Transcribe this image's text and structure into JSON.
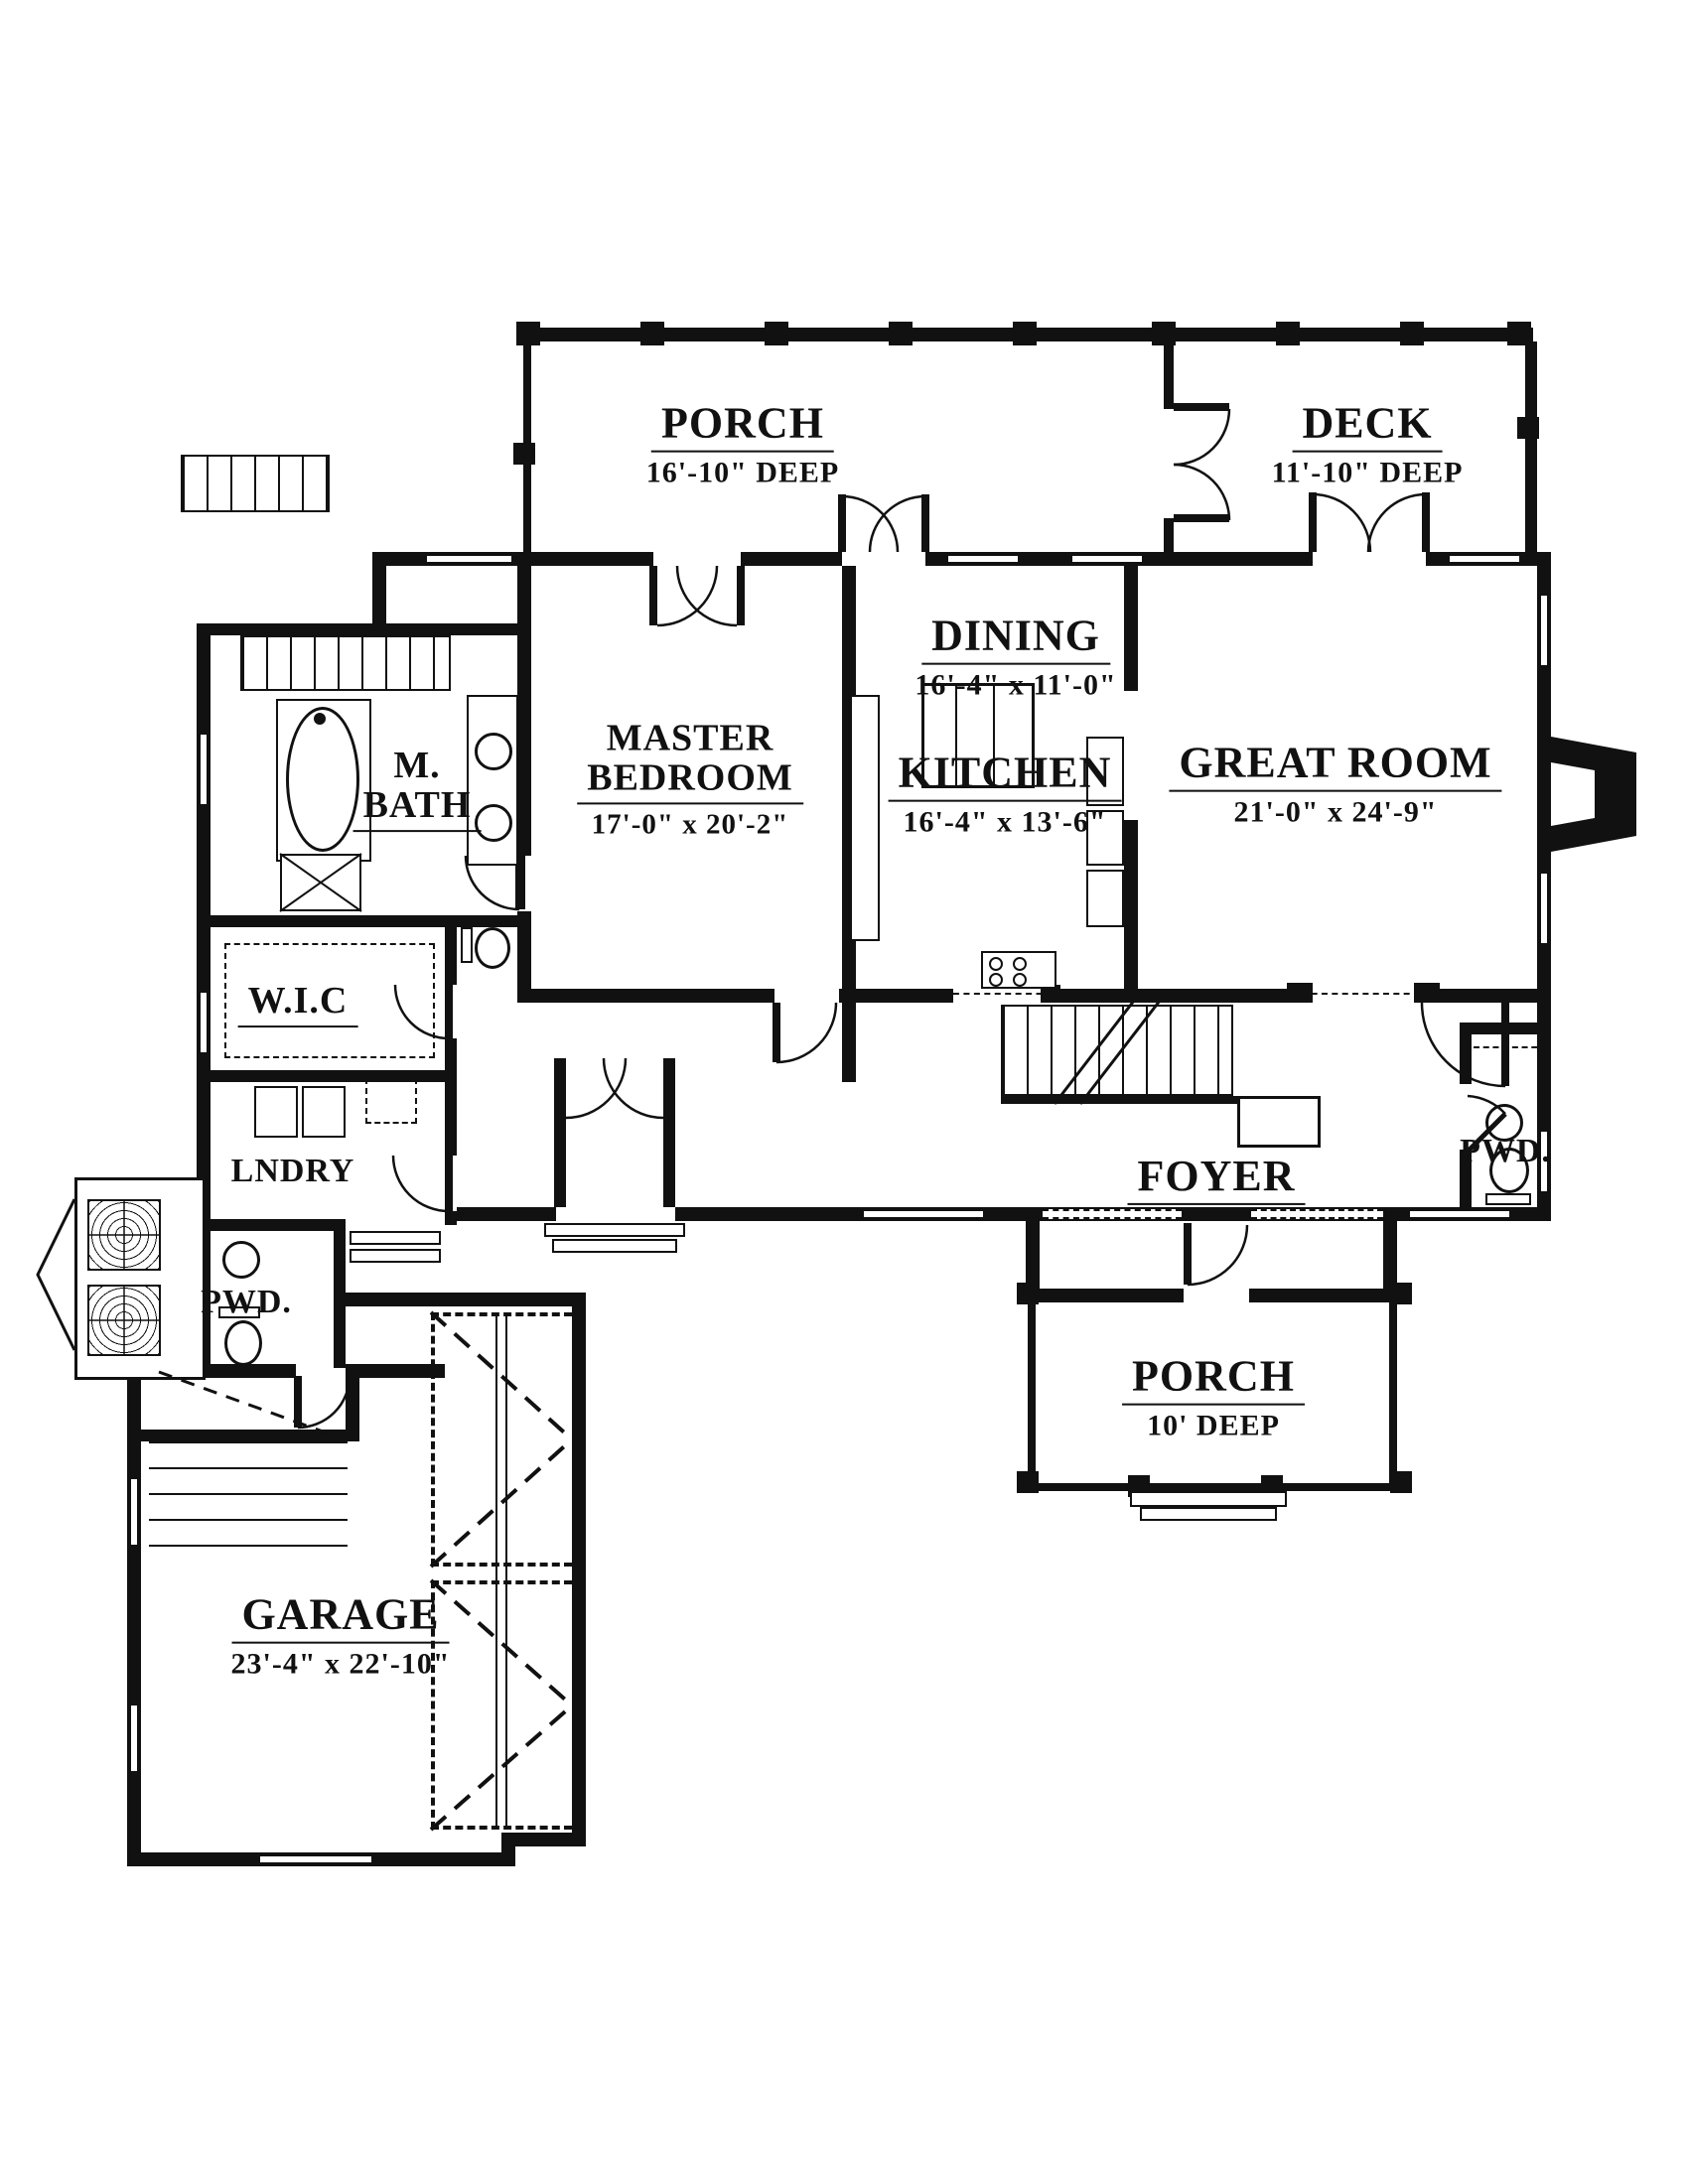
{
  "drawing": {
    "colors": {
      "ink": "#111111",
      "paper": "#ffffff"
    },
    "rooms": {
      "porch_top": {
        "name": "PORCH",
        "dims": "16'-10\" DEEP"
      },
      "deck": {
        "name": "DECK",
        "dims": "11'-10\" DEEP"
      },
      "dining": {
        "name": "DINING",
        "dims": "16'-4\" x 11'-0\""
      },
      "master_bedroom": {
        "name": "MASTER BEDROOM",
        "name_line1": "MASTER",
        "name_line2": "BEDROOM",
        "dims": "17'-0\" x 20'-2\""
      },
      "m_bath": {
        "name": "M. BATH",
        "name_line1": "M.",
        "name_line2": "BATH"
      },
      "kitchen": {
        "name": "KITCHEN",
        "dims": "16'-4\" x 13'-6\""
      },
      "great_room": {
        "name": "GREAT ROOM",
        "dims": "21'-0\" x 24'-9\""
      },
      "wic": {
        "name": "W.I.C"
      },
      "laundry": {
        "name": "LNDRY"
      },
      "powder_left": {
        "name": "PWD."
      },
      "foyer": {
        "name": "FOYER"
      },
      "powder_right": {
        "name": "PWD."
      },
      "porch_front": {
        "name": "PORCH",
        "dims": "10' DEEP"
      },
      "garage": {
        "name": "GARAGE",
        "dims": "23'-4\" x 22'-10\""
      }
    }
  }
}
